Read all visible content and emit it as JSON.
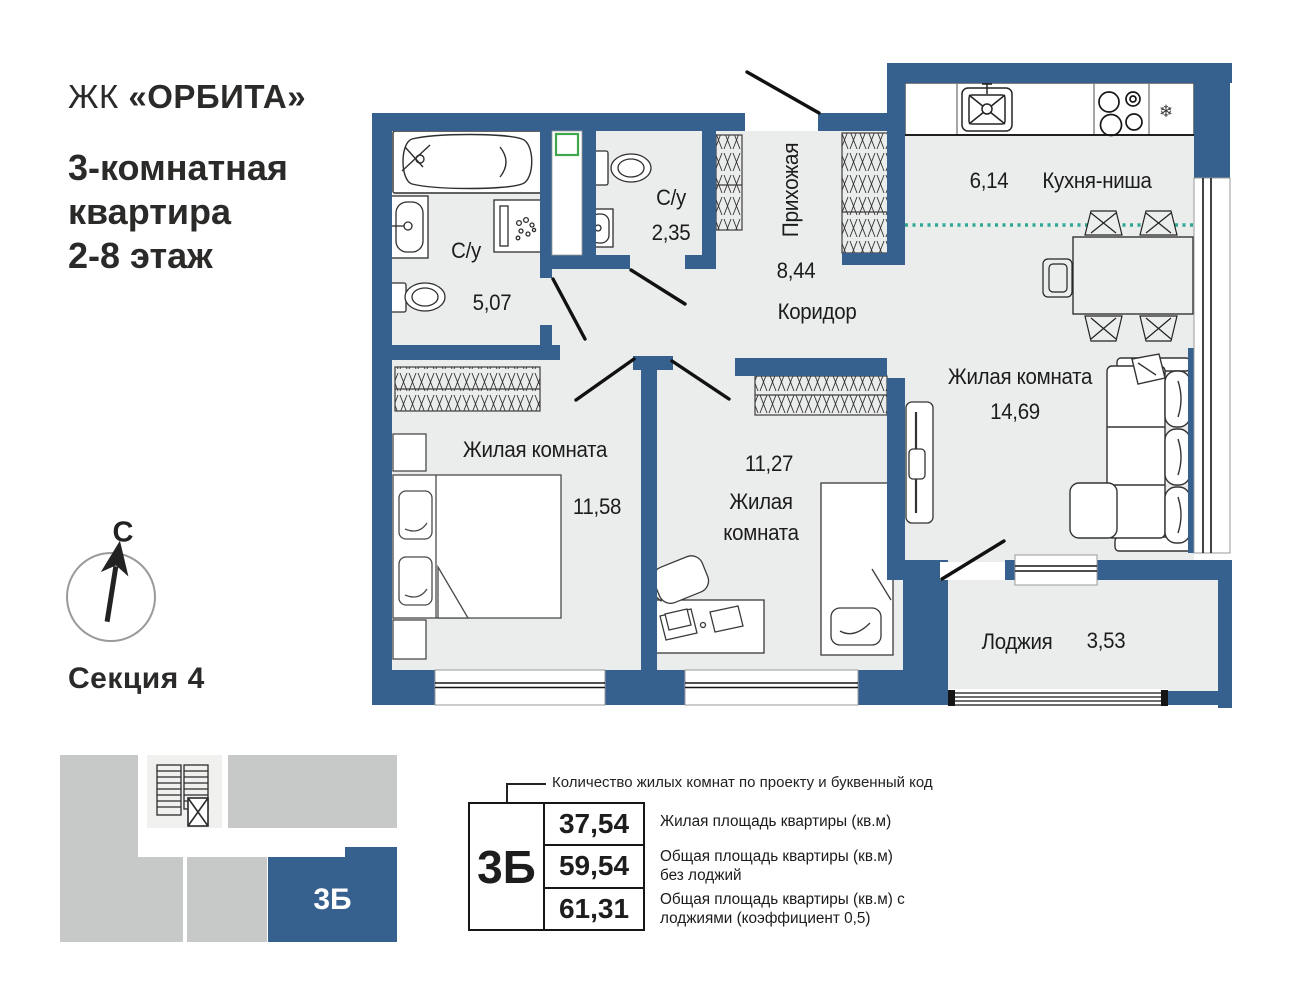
{
  "header": {
    "complex_prefix": "ЖК",
    "complex_name": "«ОРБИТА»",
    "apartment_type_lines": [
      "3-комнатная",
      "квартира",
      "2-8 этаж"
    ]
  },
  "compass": {
    "north_label": "С"
  },
  "section": {
    "label": "Секция 4",
    "unit_code": "3Б"
  },
  "plan": {
    "rooms": [
      {
        "name": "С/у",
        "area": "5,07"
      },
      {
        "name": "С/у",
        "area": "2,35"
      },
      {
        "name": "Прихожая",
        "area": "8,44"
      },
      {
        "name": "Коридор"
      },
      {
        "name": "Кухня-ниша",
        "area": "6,14"
      },
      {
        "name": "Жилая комната",
        "area": "14,69"
      },
      {
        "name": "Жилая комната",
        "area": "11,58"
      },
      {
        "name": "Жилая комната",
        "area": "11,27"
      },
      {
        "name": "Лоджия",
        "area": "3,53"
      }
    ],
    "kitchen": {
      "snowflake": "❄"
    }
  },
  "legend": {
    "callout": "Количество жилых комнат по проекту и буквенный код",
    "unit_code": "3Б",
    "rows": [
      {
        "value": "37,54",
        "label": "Жилая площадь квартиры (кв.м)"
      },
      {
        "value": "59,54",
        "label": "Общая площадь квартиры (кв.м) без лоджий"
      },
      {
        "value": "61,31",
        "label": "Общая площадь квартиры (кв.м) с лоджиями (коэффициент 0,5)"
      }
    ]
  },
  "colors": {
    "wall": "#36618E",
    "floor": "#EBEDEC",
    "accent_teal": "#2FA796",
    "vent_green": "#3FA64C",
    "minimap_gray": "#C6C9C8",
    "minimap_light": "#F0F1EF",
    "minimap_blue": "#36618E",
    "text": "#1D1D1D"
  }
}
